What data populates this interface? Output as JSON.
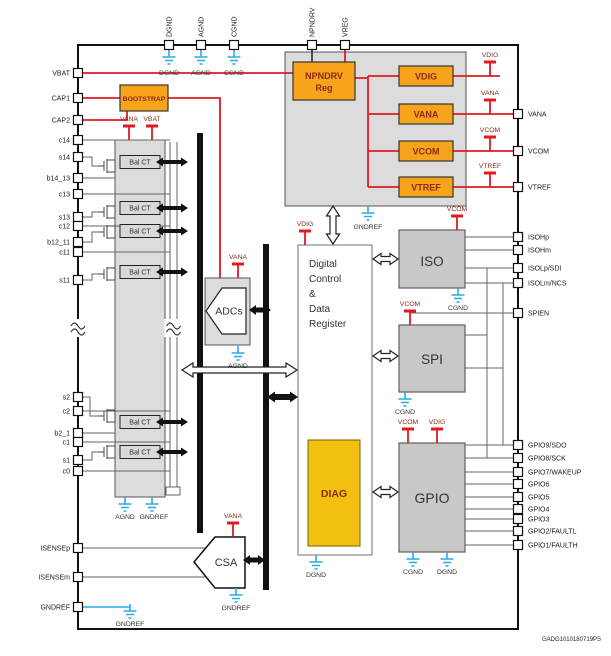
{
  "figure_id": "GADG1010180719PS",
  "colors": {
    "supply_red": "#e11a22",
    "ground_cyan": "#29abe2",
    "block_orange": "#f7a31c",
    "diag_yellow": "#f2c011",
    "block_gray": "#c8c8c8"
  },
  "pins": {
    "top": [
      "DGND",
      "AGND",
      "CGND",
      "NPNDRV",
      "VREG"
    ],
    "left": [
      "VBAT",
      "CAP1",
      "CAP2",
      "c14",
      "s14",
      "b14_13",
      "c13",
      "s13",
      "c12",
      "b12_11",
      "c11",
      "s11",
      "s2",
      "c2",
      "b2_1",
      "c1",
      "s1",
      "c0",
      "ISENSEp",
      "ISENSEm",
      "GNDREF"
    ],
    "right": [
      "VANA",
      "VCOM",
      "VTREF",
      "ISOHp",
      "ISOHm",
      "ISOLp/SDI",
      "ISOLm/NCS",
      "SPIEN",
      "GPIO9/SDO",
      "GPIO8/SCK",
      "GPIO7/WAKEUP",
      "GPIO6",
      "GPIO5",
      "GPIO4",
      "GPIO3",
      "GPIO2/FAULTL",
      "GPIO1/FAULTH"
    ]
  },
  "blocks": {
    "bootstrap": "BOOTSTRAP",
    "npndrv": [
      "NPNDRV",
      "Reg"
    ],
    "ldo": [
      "VDIG",
      "VANA",
      "VCOM",
      "VTREF"
    ],
    "bal_ct": "Bal CT",
    "adcs": "ADCs",
    "digital": [
      "Digital",
      "Control",
      "&",
      "Data",
      "Register"
    ],
    "diag": "DIAG",
    "iso": "ISO",
    "spi": "SPI",
    "gpio": "GPIO",
    "csa": "CSA"
  },
  "taps": {
    "vdig": "VDIG",
    "vana": "VANA",
    "vcom": "VCOM",
    "vtref": "VTREF",
    "vbat": "VBAT"
  },
  "grounds": {
    "dgnd": "DGND",
    "agnd": "AGND",
    "cgnd": "CGND",
    "gndref": "GNDREF"
  }
}
